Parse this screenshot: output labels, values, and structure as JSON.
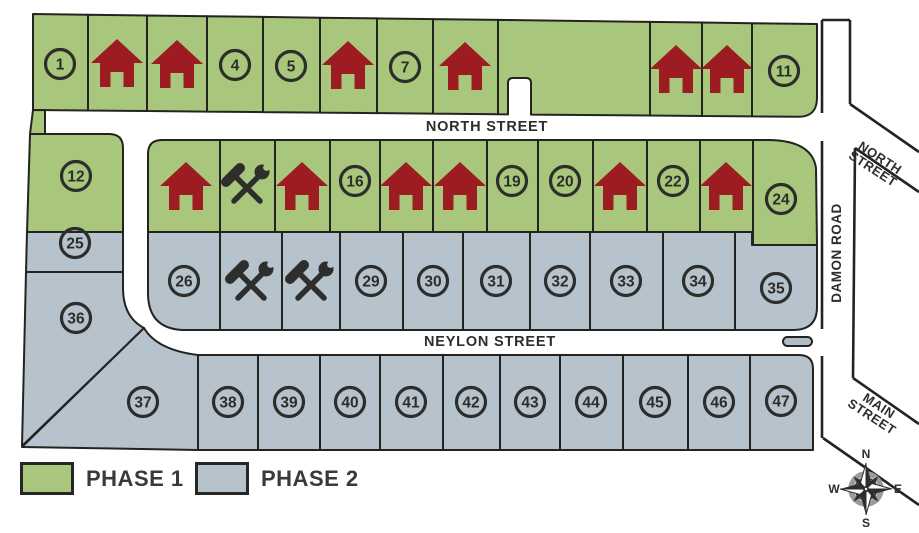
{
  "legend": {
    "items": [
      {
        "label": "PHASE 1",
        "swatch": "phase1"
      },
      {
        "label": "PHASE 2",
        "swatch": "phase2"
      }
    ]
  },
  "compass": {
    "north": "N",
    "south": "S",
    "east": "E",
    "west": "W"
  },
  "colors": {
    "phase1": "#a8c77d",
    "phase2": "#b7c3cc",
    "house": "#9d1c21",
    "icon_dark": "#2e2e2c",
    "outline": "#232320",
    "text_dark": "#2d2d2b",
    "legend_text": "#3a3a38",
    "road_line": "#232320",
    "island_fill": "#b0bdc6",
    "compass_ring": "#9b9b99",
    "white": "#ffffff"
  },
  "street_labels": [
    {
      "lines": [
        "NORTH STREET"
      ],
      "x": 487,
      "y": 131,
      "rotate": 0,
      "size": 14.5,
      "spacing": 0.8
    },
    {
      "lines": [
        "NEYLON STREET"
      ],
      "x": 490,
      "y": 346,
      "rotate": 0,
      "size": 14.5,
      "spacing": 0.8
    },
    {
      "lines": [
        "DAMON ROAD"
      ],
      "x": 841,
      "y": 253,
      "rotate": -90,
      "size": 13.5,
      "spacing": 0.5
    },
    {
      "lines": [
        "NORTH",
        "STREET"
      ],
      "x": 876,
      "y": 164,
      "rotate": 33,
      "size": 13,
      "spacing": 0.5
    },
    {
      "lines": [
        "MAIN",
        "STREET"
      ],
      "x": 875,
      "y": 412,
      "rotate": 33,
      "size": 13,
      "spacing": 0.5
    }
  ],
  "roads": {
    "damon_segments": [
      [
        822,
        20,
        850,
        20
      ],
      [
        822,
        20,
        822,
        113
      ],
      [
        822,
        141,
        822,
        329
      ],
      [
        822,
        356,
        822,
        438
      ],
      [
        850,
        20,
        850,
        104
      ],
      [
        850,
        104,
        919,
        152
      ],
      [
        919,
        192,
        855,
        148
      ],
      [
        855,
        148,
        853,
        378
      ],
      [
        853,
        378,
        919,
        424
      ],
      [
        823,
        438,
        919,
        505
      ]
    ],
    "island": [
      783,
      337,
      29,
      9
    ]
  },
  "lots": [
    {
      "label": "1",
      "marker": "number",
      "phase": 1,
      "poly": "33,14 88,14.7 88,110.5 33,110",
      "cx": 60,
      "cy": 64
    },
    {
      "label": null,
      "marker": "house",
      "phase": 1,
      "poly": "88,14.7 147,15.5 147,111 88,110.5",
      "cx": 117,
      "cy": 64
    },
    {
      "label": null,
      "marker": "house",
      "phase": 1,
      "poly": "147,15.5 207,16.2 207,111.6 147,111",
      "cx": 177,
      "cy": 65
    },
    {
      "label": "4",
      "marker": "number",
      "phase": 1,
      "poly": "207,16.2 263,16.9 263,112.1 207,111.6",
      "cx": 235,
      "cy": 65
    },
    {
      "label": "5",
      "marker": "number",
      "phase": 1,
      "poly": "263,16.9 320,17.7 320,112.6 263,112.1",
      "cx": 291,
      "cy": 66
    },
    {
      "label": null,
      "marker": "house",
      "phase": 1,
      "poly": "320,17.7 377,18.4 377,113.1 320,112.6",
      "cx": 348,
      "cy": 66
    },
    {
      "label": "7",
      "marker": "number",
      "phase": 1,
      "poly": "377,18.4 433,19.1 433,113.6 377,113.1",
      "cx": 405,
      "cy": 67
    },
    {
      "label": null,
      "marker": "house",
      "phase": 1,
      "poly": "433,19.1 498,19.9 498,114.2 433,113.6",
      "cx": 465,
      "cy": 67
    },
    {
      "label": null,
      "marker": "none",
      "phase": 1,
      "path": "M498,19.9 L650,21.9 L650,115.5 L531,114.6 L531,83 Q531,78 526,78 L513,78 Q508,78 508,83 L508,114.4 L498,114.2 Z"
    },
    {
      "label": null,
      "marker": "house",
      "phase": 1,
      "poly": "650,21.9 702,22.5 702,116 650,115.5",
      "cx": 676,
      "cy": 70
    },
    {
      "label": null,
      "marker": "house",
      "phase": 1,
      "poly": "702,22.5 752,23.2 752,116.4 702,116",
      "cx": 727,
      "cy": 70
    },
    {
      "label": "11",
      "marker": "number",
      "phase": 1,
      "path": "M752,23.2 L817,24 L817,98 Q817,116.9 798,116.8 L752,116.4 Z",
      "cx": 784,
      "cy": 71
    },
    {
      "label": null,
      "marker": "none",
      "phase": 1,
      "poly": "33,110 45,110.1 45,134 30,134"
    },
    {
      "label": "12",
      "marker": "number",
      "phase": 1,
      "path": "M30,134 L109,134 Q123,134 123,148 L123,232 L27,232 Z",
      "cx": 76,
      "cy": 176
    },
    {
      "label": null,
      "marker": "house",
      "phase": 1,
      "path": "M162,140 L220,140 L220,232 L148,232 L148,154 Q148,140 162,140 Z",
      "cx": 186,
      "cy": 187
    },
    {
      "label": null,
      "marker": "tools",
      "phase": 1,
      "rect": [
        220,
        140,
        55,
        92
      ],
      "cx": 247,
      "cy": 185
    },
    {
      "label": null,
      "marker": "house",
      "phase": 1,
      "rect": [
        275,
        140,
        55,
        92
      ],
      "cx": 302,
      "cy": 187
    },
    {
      "label": "16",
      "marker": "number",
      "phase": 1,
      "rect": [
        330,
        140,
        50,
        92
      ],
      "cx": 355,
      "cy": 181
    },
    {
      "label": null,
      "marker": "house",
      "phase": 1,
      "rect": [
        380,
        140,
        53,
        92
      ],
      "cx": 406,
      "cy": 187
    },
    {
      "label": null,
      "marker": "house",
      "phase": 1,
      "rect": [
        433,
        140,
        54,
        92
      ],
      "cx": 460,
      "cy": 187
    },
    {
      "label": "19",
      "marker": "number",
      "phase": 1,
      "rect": [
        487,
        140,
        51,
        92
      ],
      "cx": 512,
      "cy": 181
    },
    {
      "label": "20",
      "marker": "number",
      "phase": 1,
      "rect": [
        538,
        140,
        55,
        92
      ],
      "cx": 565,
      "cy": 181
    },
    {
      "label": null,
      "marker": "house",
      "phase": 1,
      "rect": [
        593,
        140,
        54,
        92
      ],
      "cx": 620,
      "cy": 187
    },
    {
      "label": "22",
      "marker": "number",
      "phase": 1,
      "rect": [
        647,
        140,
        53,
        92
      ],
      "cx": 673,
      "cy": 181
    },
    {
      "label": null,
      "marker": "house",
      "phase": 1,
      "rect": [
        700,
        140,
        53,
        92
      ],
      "cx": 726,
      "cy": 187
    },
    {
      "label": "24",
      "marker": "number",
      "phase": 1,
      "path": "M753,140 L770,140 Q812,141 816,168 L817,245 L753,245 Z",
      "cx": 781,
      "cy": 199
    },
    {
      "label": "25",
      "marker": "number",
      "phase": 2,
      "poly": "27,232 123,232 123,272 26,272",
      "cx": 75,
      "cy": 243
    },
    {
      "label": "36",
      "marker": "number",
      "phase": 2,
      "path": "M26,272 L123,272 L123,288 Q123,317 144,328 L22,446 Z",
      "cx": 76,
      "cy": 318
    },
    {
      "label": "26",
      "marker": "number",
      "phase": 2,
      "path": "M148,232 L220,232 L220,330 L182,330 Q148,328 148,293 Z",
      "cx": 184,
      "cy": 281
    },
    {
      "label": null,
      "marker": "tools",
      "phase": 2,
      "rect": [
        220,
        232,
        62,
        98
      ],
      "cx": 251,
      "cy": 282
    },
    {
      "label": null,
      "marker": "tools",
      "phase": 2,
      "rect": [
        282,
        232,
        58,
        98
      ],
      "cx": 311,
      "cy": 282
    },
    {
      "label": "29",
      "marker": "number",
      "phase": 2,
      "rect": [
        340,
        232,
        63,
        98
      ],
      "cx": 371,
      "cy": 281
    },
    {
      "label": "30",
      "marker": "number",
      "phase": 2,
      "rect": [
        403,
        232,
        60,
        98
      ],
      "cx": 433,
      "cy": 281
    },
    {
      "label": "31",
      "marker": "number",
      "phase": 2,
      "rect": [
        463,
        232,
        67,
        98
      ],
      "cx": 496,
      "cy": 281
    },
    {
      "label": "32",
      "marker": "number",
      "phase": 2,
      "rect": [
        530,
        232,
        60,
        98
      ],
      "cx": 560,
      "cy": 281
    },
    {
      "label": "33",
      "marker": "number",
      "phase": 2,
      "rect": [
        590,
        232,
        73,
        98
      ],
      "cx": 626,
      "cy": 281
    },
    {
      "label": "34",
      "marker": "number",
      "phase": 2,
      "rect": [
        663,
        232,
        72,
        98
      ],
      "cx": 698,
      "cy": 281
    },
    {
      "label": "35",
      "marker": "number",
      "phase": 2,
      "path": "M735,232 L752,232 L752,245 L817,245 L817,307 Q817,330 793,330 L735,330 Z",
      "cx": 776,
      "cy": 288
    },
    {
      "label": "37",
      "marker": "number",
      "phase": 2,
      "path": "M144,328 Q157,350 198,355 L198,450 L22,447 Z",
      "cx": 143,
      "cy": 402
    },
    {
      "label": "38",
      "marker": "number",
      "phase": 2,
      "rect": [
        198,
        355,
        60,
        95
      ],
      "cx": 228,
      "cy": 402
    },
    {
      "label": "39",
      "marker": "number",
      "phase": 2,
      "rect": [
        258,
        355,
        62,
        95
      ],
      "cx": 289,
      "cy": 402
    },
    {
      "label": "40",
      "marker": "number",
      "phase": 2,
      "rect": [
        320,
        355,
        60,
        95
      ],
      "cx": 350,
      "cy": 402
    },
    {
      "label": "41",
      "marker": "number",
      "phase": 2,
      "rect": [
        380,
        355,
        63,
        95
      ],
      "cx": 411,
      "cy": 402
    },
    {
      "label": "42",
      "marker": "number",
      "phase": 2,
      "rect": [
        443,
        355,
        57,
        95
      ],
      "cx": 471,
      "cy": 402
    },
    {
      "label": "43",
      "marker": "number",
      "phase": 2,
      "rect": [
        500,
        355,
        60,
        95
      ],
      "cx": 530,
      "cy": 402
    },
    {
      "label": "44",
      "marker": "number",
      "phase": 2,
      "rect": [
        560,
        355,
        63,
        95
      ],
      "cx": 591,
      "cy": 402
    },
    {
      "label": "45",
      "marker": "number",
      "phase": 2,
      "rect": [
        623,
        355,
        65,
        95
      ],
      "cx": 655,
      "cy": 402
    },
    {
      "label": "46",
      "marker": "number",
      "phase": 2,
      "rect": [
        688,
        355,
        62,
        95
      ],
      "cx": 719,
      "cy": 402
    },
    {
      "label": "47",
      "marker": "number",
      "phase": 2,
      "path": "M750,355 L799,355 Q813,355 813,369 L813,450 L750,450 Z",
      "cx": 781,
      "cy": 401
    }
  ]
}
